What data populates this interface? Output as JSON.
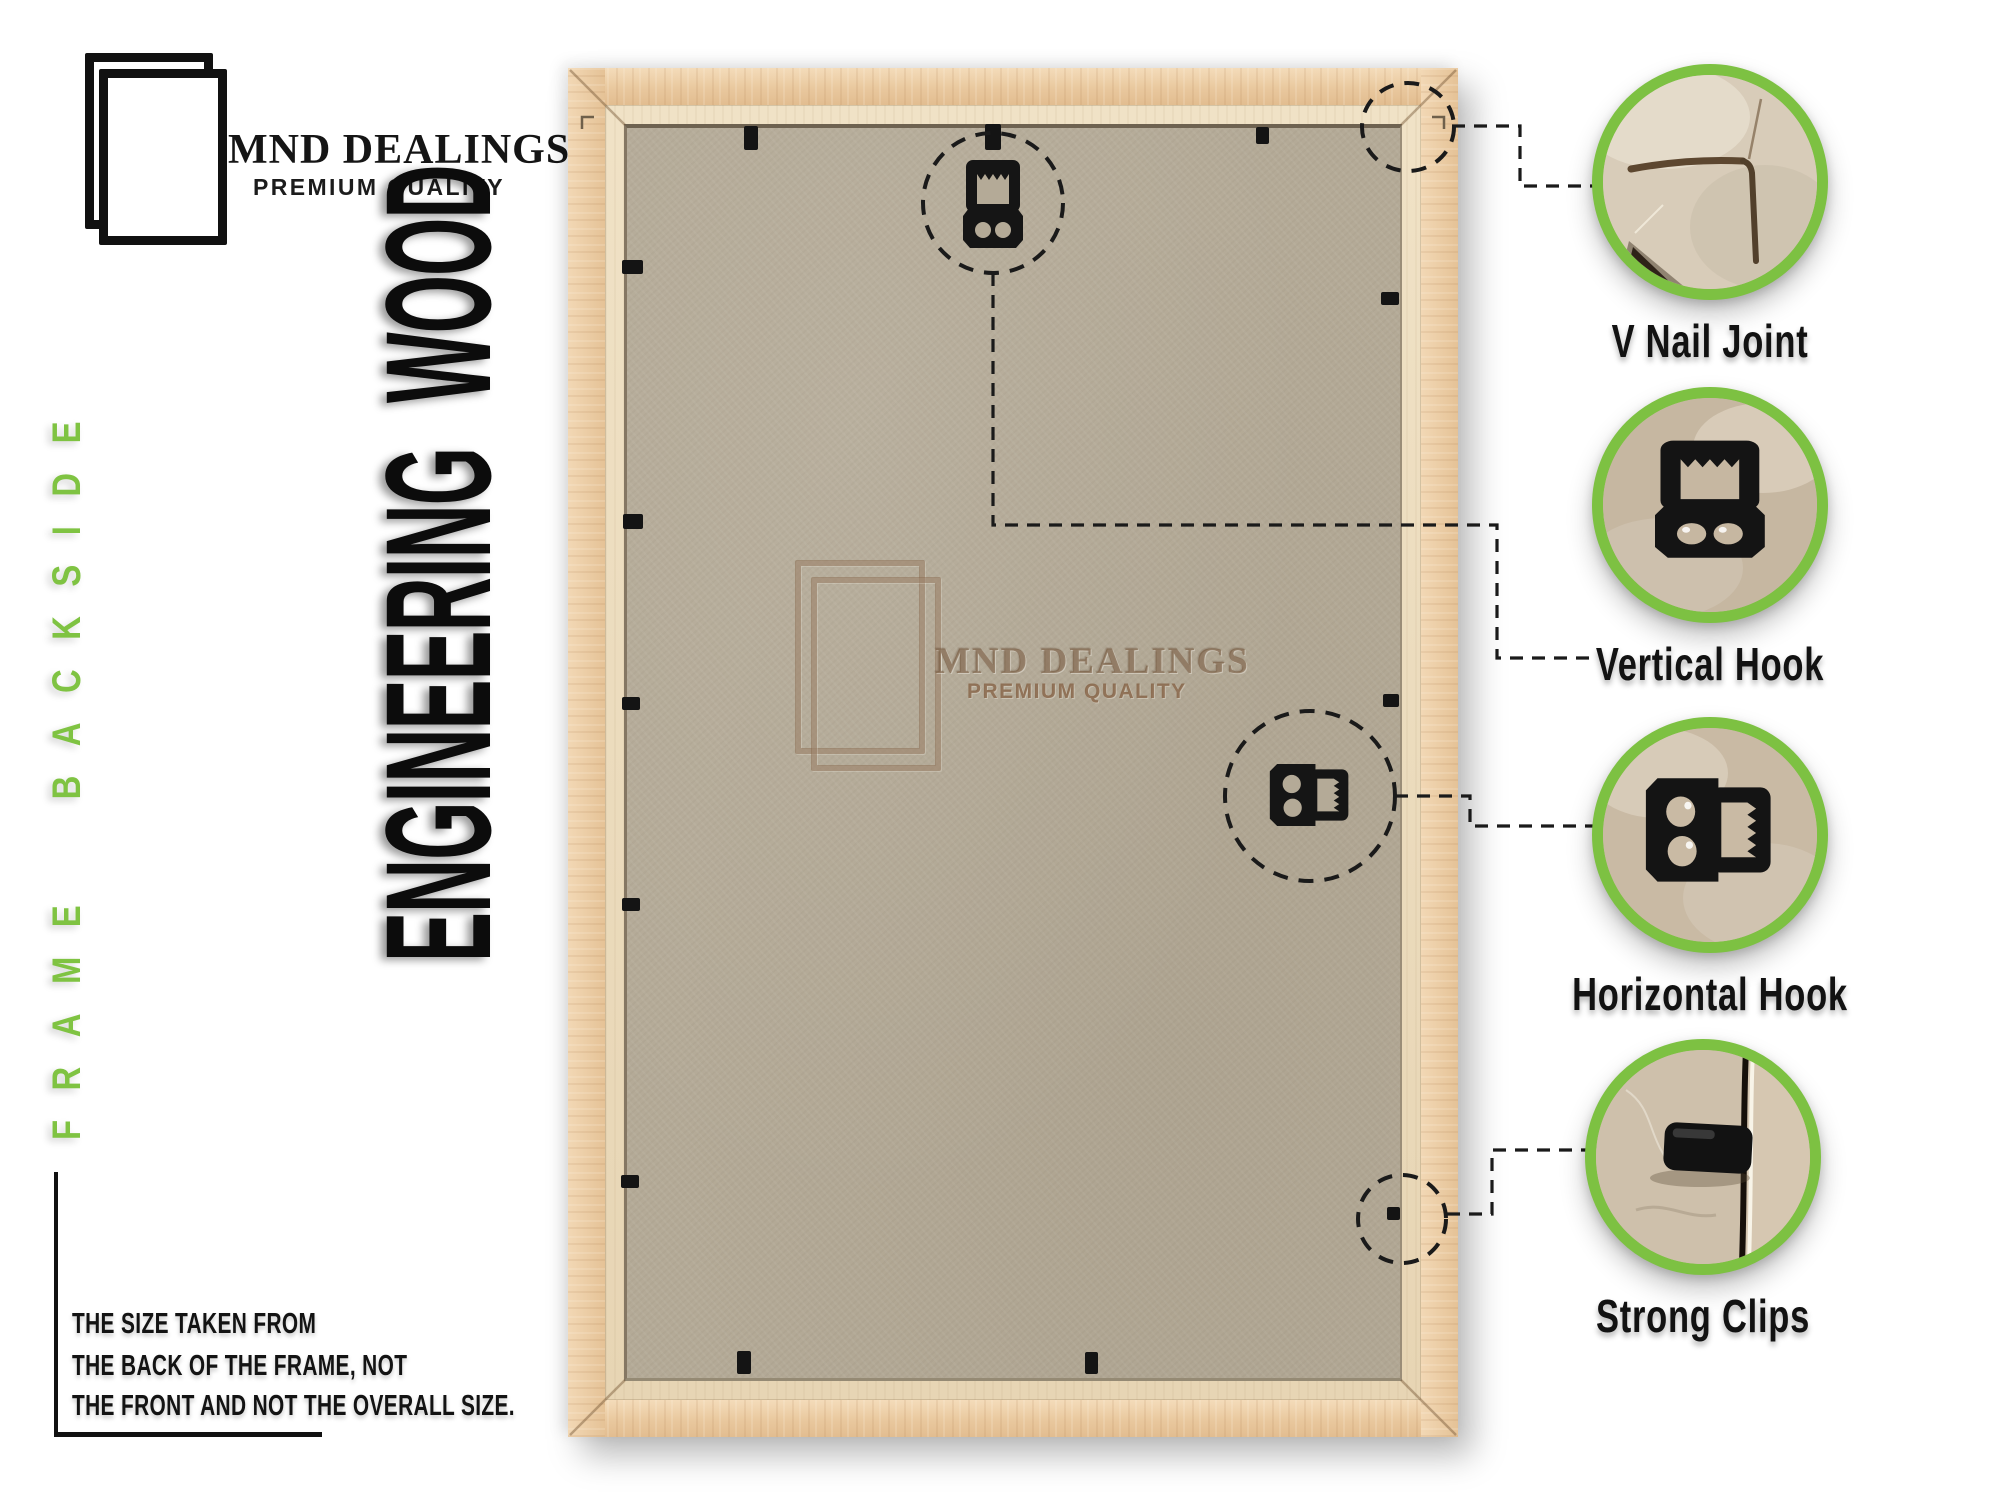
{
  "brand": {
    "name": "MND DEALINGS",
    "tagline": "PREMIUM QUALITY"
  },
  "side_label": "FRAME BACKSIDE",
  "material_label": "ENGINEERING WOOD",
  "watermark": {
    "name": "MND DEALINGS",
    "tagline": "PREMIUM QUALITY"
  },
  "note": {
    "line1": "THE SIZE TAKEN FROM",
    "line2": "THE BACK OF THE FRAME, NOT",
    "line3": "THE FRONT AND NOT THE OVERALL SIZE."
  },
  "callouts": [
    {
      "id": "v-nail-joint",
      "label": "V Nail Joint",
      "icon": "v-nail-joint-photo"
    },
    {
      "id": "vertical-hook",
      "label": "Vertical Hook",
      "icon": "vertical-hook-photo"
    },
    {
      "id": "horizontal-hook",
      "label": "Horizontal Hook",
      "icon": "horizontal-hook-photo"
    },
    {
      "id": "strong-clips",
      "label": "Strong Clips",
      "icon": "strong-clips-photo"
    }
  ],
  "icons": {
    "brand_logo": "double-frame-outline",
    "watermark_logo": "double-frame-outline-embossed",
    "frame_hardware": [
      "vertical-hook",
      "horizontal-hook",
      "metal-clips",
      "dashed-highlight-circles"
    ]
  },
  "colors": {
    "accent_green": "#7DC142",
    "wood": "#E9C9A3",
    "mdf_board": "#B4AA97",
    "ink": "#111111",
    "watermark_brown": "#8B6C50"
  }
}
